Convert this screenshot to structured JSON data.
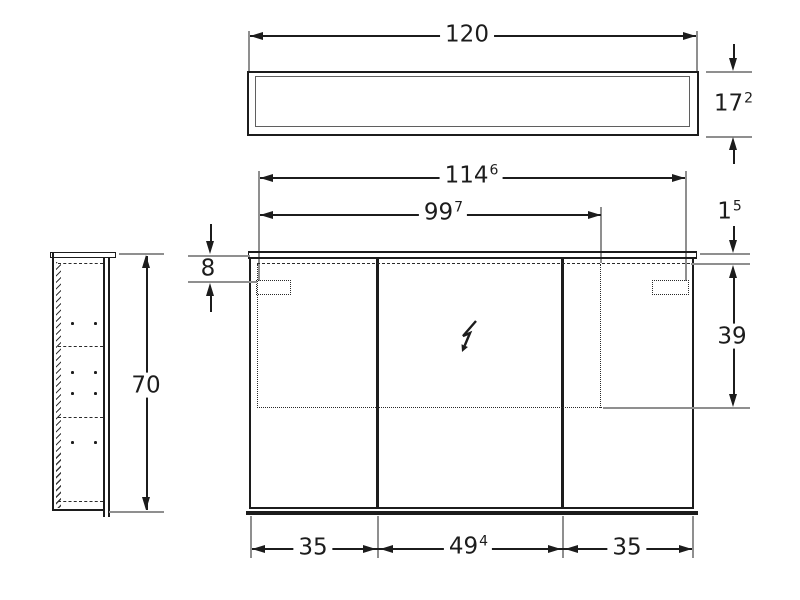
{
  "drawing_labels": {
    "top_width": {
      "main": "120"
    },
    "top_depth": {
      "main": "17",
      "sup": "2"
    },
    "side_height": {
      "main": "70"
    },
    "front_width": {
      "main": "114",
      "sup": "6"
    },
    "light_width": {
      "main": "99",
      "sup": "7"
    },
    "top_profile": {
      "main": "1",
      "sup": "5"
    },
    "sensor_offset": {
      "main": "8"
    },
    "mirror_zone_height": {
      "main": "39"
    },
    "door_left": {
      "main": "35"
    },
    "door_center": {
      "main": "49",
      "sup": "4"
    },
    "door_right": {
      "main": "35"
    }
  },
  "icons": {
    "power_connection": "lightning-bolt-icon"
  },
  "colors": {
    "line": "#1c1c1c",
    "extension_line": "#8f8f8f",
    "background": "#ffffff"
  }
}
